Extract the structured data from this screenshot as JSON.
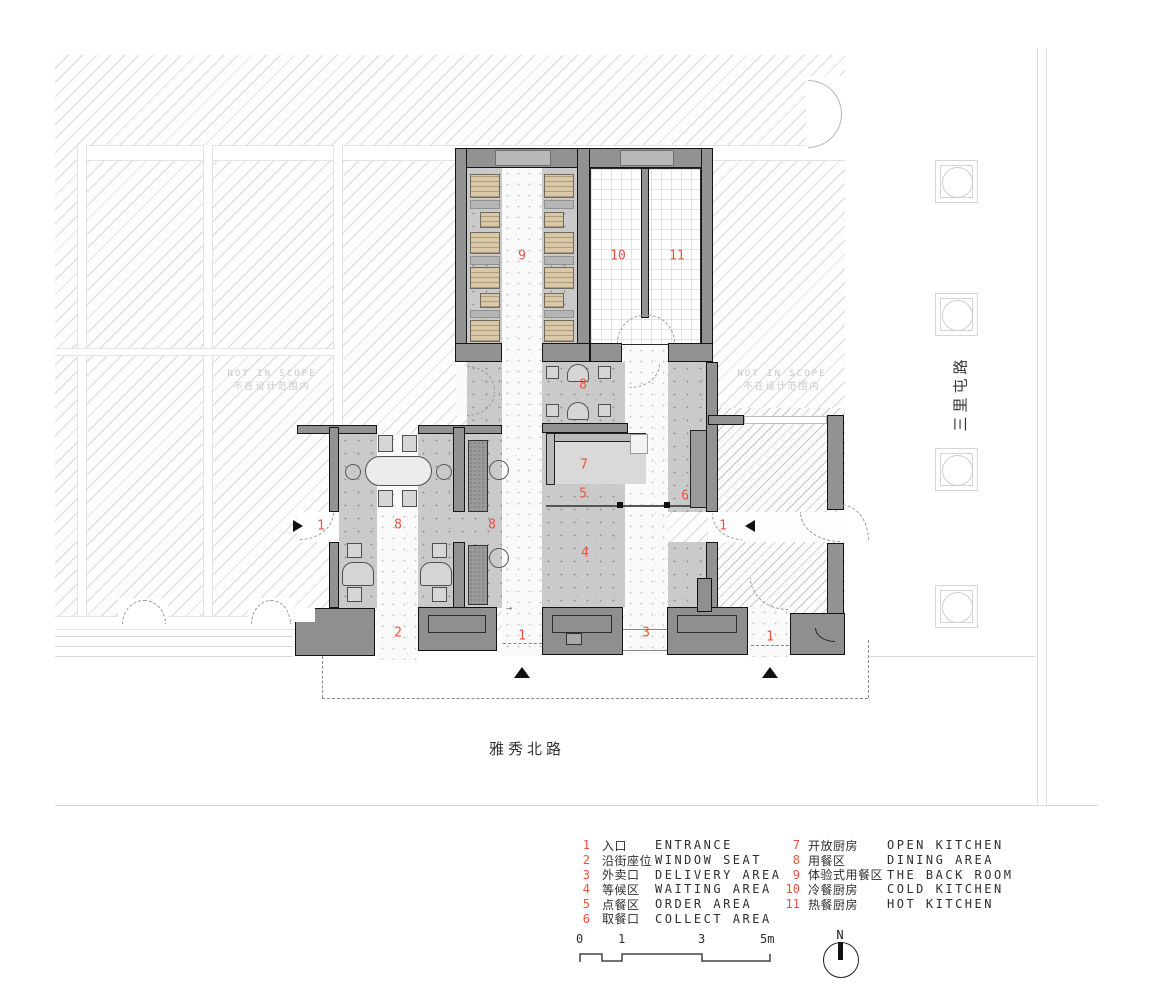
{
  "colors": {
    "accent_red": "#ee5140",
    "wall_gray": "#929292",
    "wood_tan": "#d9c7a6",
    "floor_gray": "#cacaca"
  },
  "annotations": {
    "not_in_scope_en": "NOT IN SCOPE",
    "not_in_scope_zh": "不在设计范围内",
    "street_bottom": "雅秀北路",
    "street_right": "三里屯路",
    "entry_hint_arrow": "→"
  },
  "plan": {
    "markers": [
      {
        "label": "1",
        "x": 321,
        "y": 526
      },
      {
        "label": "1",
        "x": 723,
        "y": 526
      },
      {
        "label": "1",
        "x": 522,
        "y": 636
      },
      {
        "label": "1",
        "x": 770,
        "y": 637
      },
      {
        "label": "2",
        "x": 398,
        "y": 633
      },
      {
        "label": "3",
        "x": 646,
        "y": 633
      },
      {
        "label": "4",
        "x": 585,
        "y": 553
      },
      {
        "label": "5",
        "x": 583,
        "y": 494
      },
      {
        "label": "6",
        "x": 685,
        "y": 496
      },
      {
        "label": "7",
        "x": 584,
        "y": 465
      },
      {
        "label": "8",
        "x": 583,
        "y": 385
      },
      {
        "label": "8",
        "x": 398,
        "y": 525
      },
      {
        "label": "8",
        "x": 492,
        "y": 525
      },
      {
        "label": "9",
        "x": 522,
        "y": 256
      },
      {
        "label": "10",
        "x": 618,
        "y": 256
      },
      {
        "label": "11",
        "x": 677,
        "y": 256
      }
    ]
  },
  "legend": {
    "columns": [
      [
        {
          "num": "1",
          "zh": "入口",
          "en": "ENTRANCE"
        },
        {
          "num": "2",
          "zh": "沿街座位",
          "en": "WINDOW SEAT"
        },
        {
          "num": "3",
          "zh": "外卖口",
          "en": "DELIVERY AREA"
        },
        {
          "num": "4",
          "zh": "等候区",
          "en": "WAITING AREA"
        },
        {
          "num": "5",
          "zh": "点餐区",
          "en": "ORDER AREA"
        },
        {
          "num": "6",
          "zh": "取餐口",
          "en": "COLLECT AREA"
        }
      ],
      [
        {
          "num": "7",
          "zh": "开放厨房",
          "en": "OPEN KITCHEN"
        },
        {
          "num": "8",
          "zh": "用餐区",
          "en": "DINING AREA"
        },
        {
          "num": "9",
          "zh": "体验式用餐区",
          "en": "THE BACK ROOM"
        },
        {
          "num": "10",
          "zh": "冷餐厨房",
          "en": "COLD KITCHEN"
        },
        {
          "num": "11",
          "zh": "热餐厨房",
          "en": "HOT KITCHEN"
        }
      ]
    ]
  },
  "scale_bar": {
    "ticks": [
      "0",
      "1",
      "3",
      "5m"
    ]
  },
  "compass": {
    "label": "N"
  }
}
